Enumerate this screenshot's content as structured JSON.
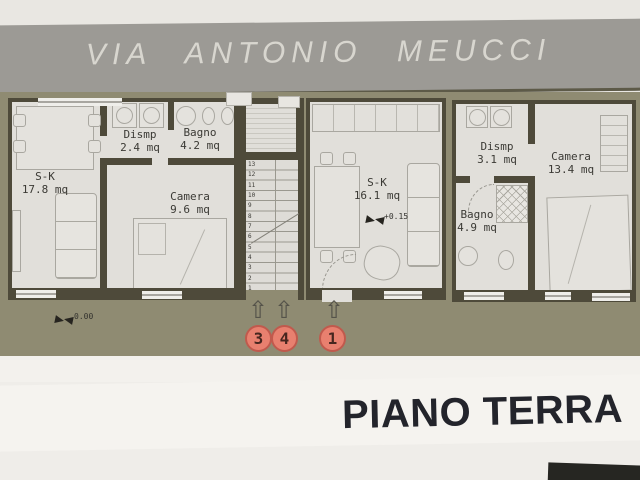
{
  "street": {
    "name": "VIA ANTONIO MEUCCI"
  },
  "floor_title": "PIANO TERRA",
  "icons": {
    "entrance_arrow_icon": "⇧",
    "level_marker_icon": "css-bowtie"
  },
  "levels": {
    "ground": "0.00",
    "interior": "+0.15"
  },
  "units": {
    "left": {
      "living": {
        "name": "S-K",
        "area": "17.8 mq"
      },
      "dismp": {
        "name": "Dismp",
        "area": "2.4 mq"
      },
      "bagno": {
        "name": "Bagno",
        "area": "4.2 mq"
      },
      "camera": {
        "name": "Camera",
        "area": "9.6 mq"
      }
    },
    "middle": {
      "living": {
        "name": "S-K",
        "area": "16.1 mq"
      }
    },
    "right": {
      "dismp": {
        "name": "Dismp",
        "area": "3.1 mq"
      },
      "camera": {
        "name": "Camera",
        "area": "13.4 mq"
      },
      "bagno": {
        "name": "Bagno",
        "area": "4.9 mq"
      }
    }
  },
  "entrances": {
    "markers": [
      "3",
      "4",
      "1"
    ]
  },
  "stairs": {
    "steps": [
      "13",
      "12",
      "11",
      "10",
      "9",
      "8",
      "7",
      "6",
      "5",
      "4",
      "3",
      "2",
      "1"
    ]
  },
  "colors": {
    "road": "#9c9a95",
    "ground": "#8f8b72",
    "wall": "#4e4a3a",
    "floor": "#e1dfda",
    "paper": "#efede9",
    "entrance_marker": "#e8806f",
    "title_text": "#23242b"
  }
}
